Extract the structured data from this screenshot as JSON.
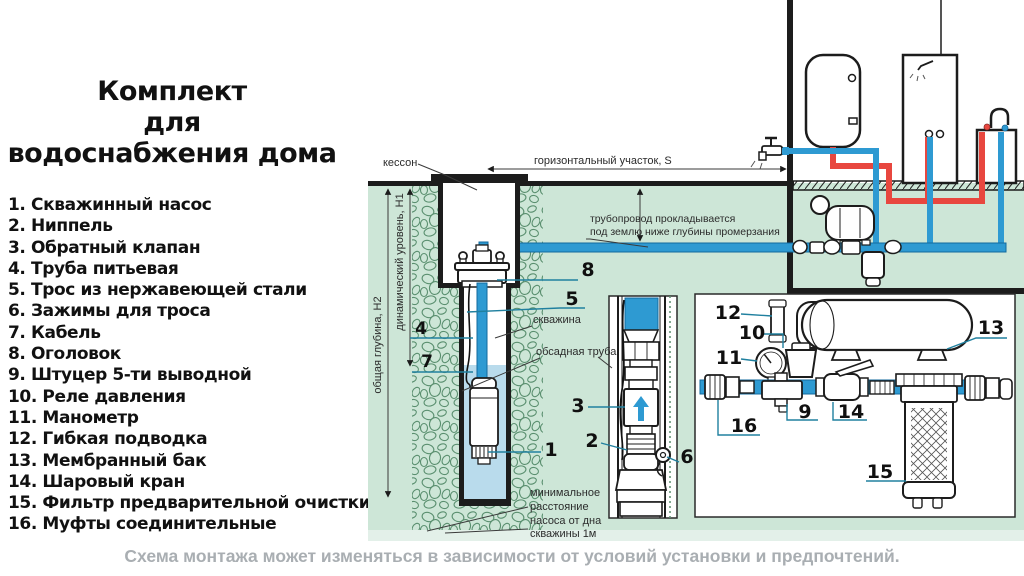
{
  "title": {
    "lines": [
      "Комплект",
      "для",
      "водоснабжения дома"
    ]
  },
  "parts": [
    "1. Скважинный насос",
    "2. Ниппель",
    "3. Обратный клапан",
    "4. Труба питьевая",
    "5. Трос из нержавеющей стали",
    "6. Зажимы для троса",
    "7. Кабель",
    "8. Оголовок",
    "9. Штуцер 5-ти выводной",
    "10. Реле давления",
    "11. Манометр",
    "12. Гибкая подводка",
    "13. Мембранный бак",
    "14. Шаровый кран",
    "15. Фильтр предварительной очистки",
    "16. Муфты соединительные"
  ],
  "footer": {
    "note": "Схема монтажа может изменяться в зависимости от условий установки и предпочтений."
  },
  "diagram": {
    "labels": {
      "kesson": "кессон",
      "horizontal": "горизонтальный участок, S",
      "pipeline1": "трубопровод прокладывается",
      "pipeline2": "под землю ниже глубины промерзания",
      "h2": "общая глубина, Н2",
      "h1": "динамический уровень, Н1",
      "borehole": "скважина",
      "casing": "обсадная труба",
      "min1": "минимальное",
      "min2": "расстояние",
      "min3": "насоса от дна",
      "min4": "скважины 1м"
    },
    "callouts": {
      "n1": "1",
      "n2": "2",
      "n3": "3",
      "n4": "4",
      "n5": "5",
      "n6": "6",
      "n7": "7",
      "n8": "8",
      "n9": "9",
      "n10": "10",
      "n11": "11",
      "n12": "12",
      "n13": "13",
      "n14": "14",
      "n15": "15",
      "n16": "16"
    },
    "colors": {
      "ground": "#cde6d7",
      "ground_light": "#e3f0e9",
      "stone": "#5a8f6f",
      "pipe_blue": "#2e9ad2",
      "pipe_red": "#e8473f",
      "well_water": "#b9dbec",
      "leader": "#20809f",
      "line_black": "#1c1c1c",
      "footer_gray": "#a9aeb2"
    }
  }
}
